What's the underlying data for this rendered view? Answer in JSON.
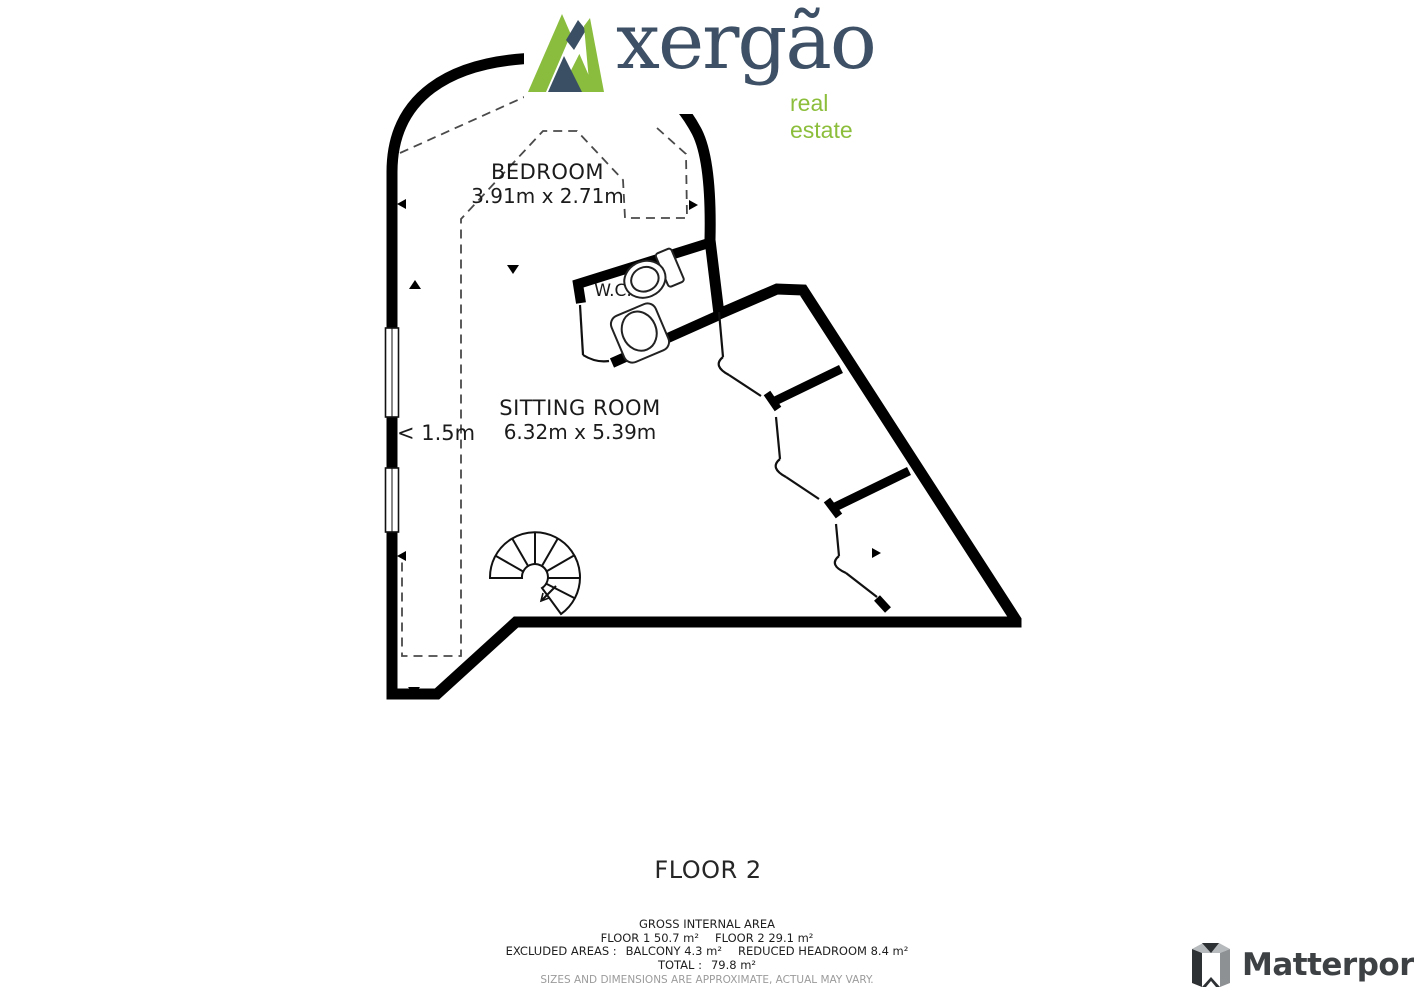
{
  "branding": {
    "logo_text": "xergão",
    "logo_tagline": "real estate",
    "logo_green": "#8abd3e",
    "logo_navy": "#3a4f63"
  },
  "floorplan": {
    "rooms": [
      {
        "name": "BEDROOM",
        "dimensions": "3.91m x 2.71m"
      },
      {
        "name": "SITTING ROOM",
        "dimensions": "6.32m x 5.39m"
      },
      {
        "name": "W.C.",
        "dimensions": ""
      }
    ],
    "headroom_label": "< 1.5m"
  },
  "footer": {
    "floor_title": "FLOOR 2",
    "area_summary": {
      "title": "GROSS INTERNAL AREA",
      "floor1": "FLOOR 1 50.7 m²",
      "floor2": "FLOOR 2 29.1 m²",
      "excluded_label": "EXCLUDED AREAS :",
      "excluded_balcony": "BALCONY 4.3 m²",
      "excluded_headroom": "REDUCED HEADROOM 8.4 m²",
      "total_label": "TOTAL :",
      "total_value": "79.8 m²",
      "disclaimer": "SIZES AND DIMENSIONS ARE APPROXIMATE, ACTUAL MAY VARY."
    }
  },
  "watermark": {
    "name": "Matterport"
  }
}
